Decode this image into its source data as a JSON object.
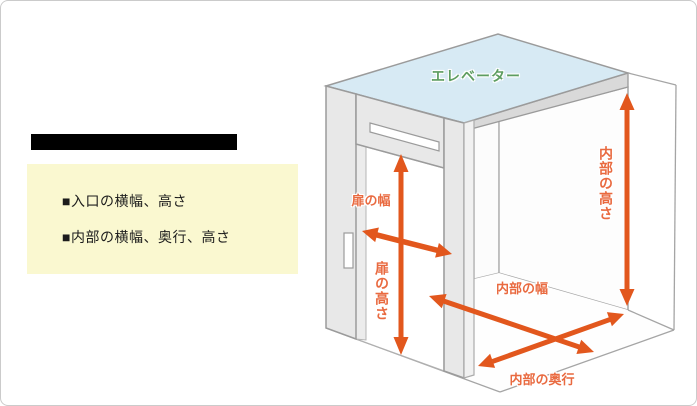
{
  "page": {
    "background": "#ffffff",
    "border_color": "#cbcbcb"
  },
  "left_panel": {
    "redacted_bar_color": "#000000",
    "note_box": {
      "background": "#faf8d0",
      "text_color": "#1c1c1c",
      "items": [
        {
          "label": "■入口の横幅、高さ"
        },
        {
          "label": "■内部の横幅、奥行、高さ"
        }
      ]
    }
  },
  "diagram": {
    "title": "エレベーター",
    "title_color": "#5d9d60",
    "ceiling_color": "#d7eaf4",
    "wall_color": "#e8e8e8",
    "outline_color": "#9b9b9b",
    "arrow_color": "#e2571d",
    "label_color": "#e96a40",
    "labels": {
      "door_width": "扉の幅",
      "door_height": "扉の高さ",
      "interior_height": "内部の高さ",
      "interior_width": "内部の幅",
      "interior_depth": "内部の奥行"
    }
  }
}
